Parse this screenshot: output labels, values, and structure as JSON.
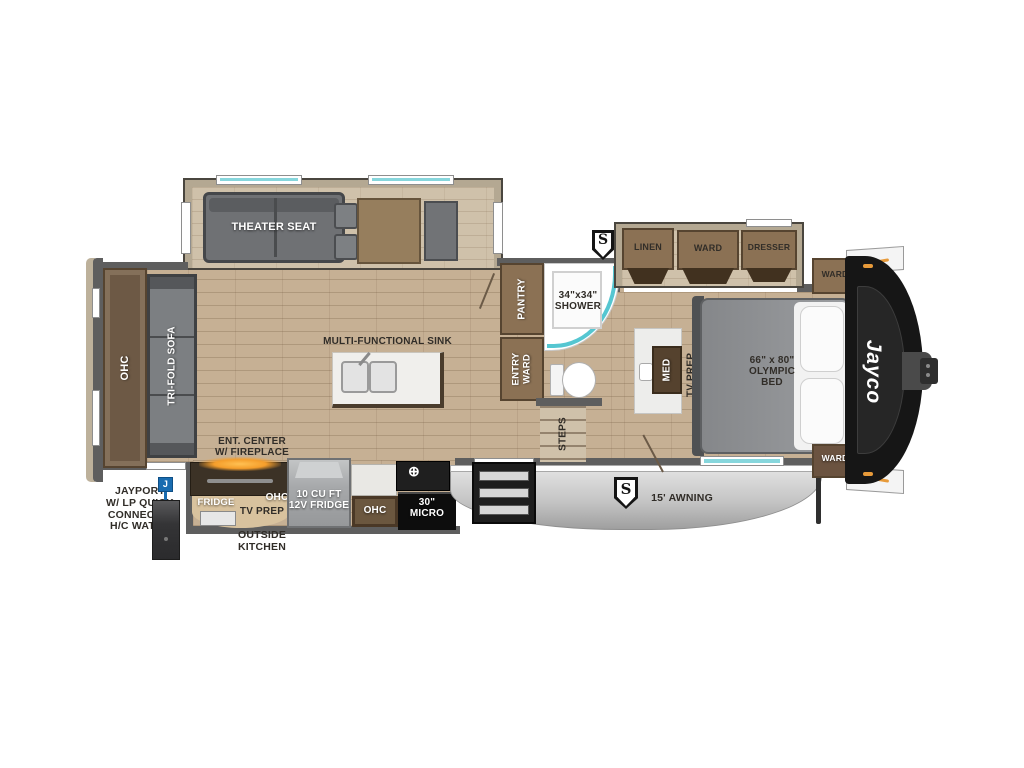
{
  "meta": {
    "type": "rv-floorplan",
    "brand": "Jayco"
  },
  "colors": {
    "accent_teal": "#5ec9d4",
    "brand_black": "#161616",
    "marker_blue": "#1a6cb0",
    "fireplace_orange": "#f59e2b",
    "wood_floor": "#c6b094",
    "cabinet_brown": "#8b7154",
    "furniture_gray": "#7d8083",
    "awning_gray": "#c6c6c6"
  },
  "living": {
    "theater_seat": "THEATER SEAT",
    "tri_fold_sofa": "TRI-FOLD SOFA",
    "ohc": "OHC",
    "sink": "MULTI-FUNCTIONAL SINK",
    "ent_center": "ENT. CENTER\nW/ FIREPLACE"
  },
  "kitchen": {
    "fridge_12v": "10 CU FT\n12V FRIDGE",
    "ohc": "OHC",
    "micro": "30\"\nMICRO",
    "burner_icon": "⊕"
  },
  "outside_kitchen": {
    "title": "OUTSIDE\nKITCHEN",
    "fridge": "FRIDGE",
    "tv_prep": "TV PREP",
    "ohc": "OHC"
  },
  "utilities": {
    "jayport": "JAYPORT\nW/ LP QUICK\nCONNECT &\nH/C WATER",
    "j_marker": "J"
  },
  "bath": {
    "pantry": "PANTRY",
    "entry_ward": "ENTRY\nWARD",
    "shower": "34\"x34\"\nSHOWER",
    "steps": "STEPS"
  },
  "bedroom": {
    "linen": "LINEN",
    "ward": "WARD",
    "dresser": "DRESSER",
    "ward_top": "WARD",
    "ward_bottom": "WARD",
    "med": "MED",
    "tv_prep": "TV PREP",
    "bed": "66\" x 80\"\nOLYMPIC\nBED"
  },
  "exterior": {
    "awning": "15' AWNING",
    "s_top": "S",
    "s_awning": "S",
    "logo": "Jayco"
  }
}
